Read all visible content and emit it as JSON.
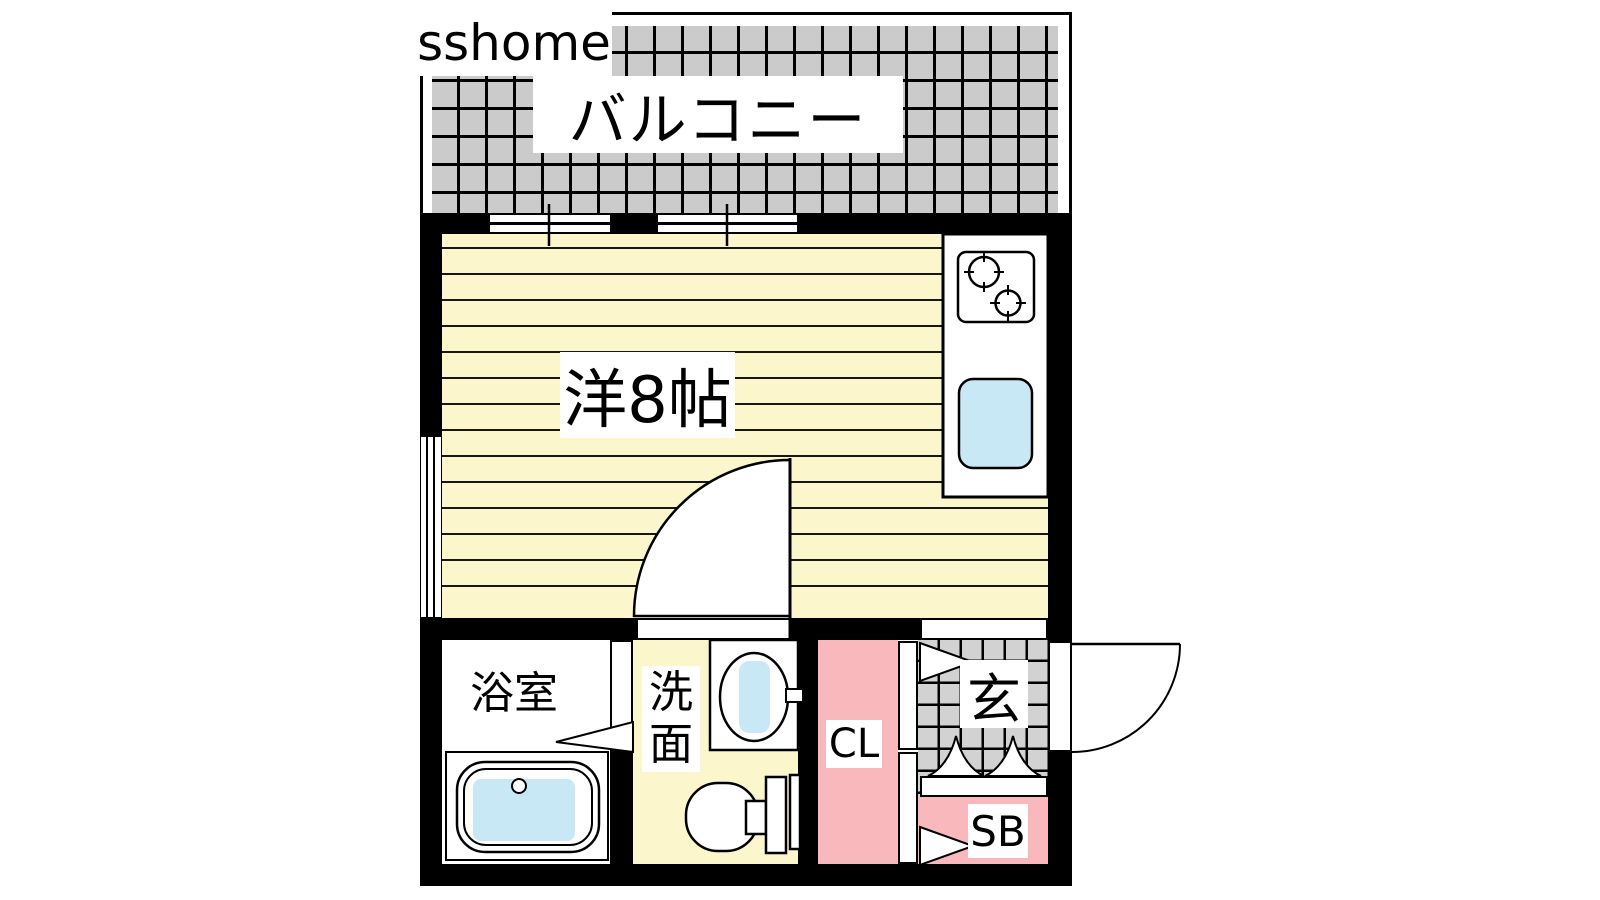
{
  "watermark": "sshome",
  "rooms": {
    "balcony": {
      "label": "バルコニー"
    },
    "main_room": {
      "label": "洋8帖"
    },
    "bathroom": {
      "label": "浴室"
    },
    "washroom": {
      "label": "洗面",
      "char1": "洗",
      "char2": "面"
    },
    "closet": {
      "label": "CL"
    },
    "entrance": {
      "label": "玄"
    },
    "shoe_box": {
      "label": "SB"
    }
  },
  "colors": {
    "wall": "#000000",
    "floor_yellow": "#fbf6cb",
    "balcony_gray": "#cbcbcb",
    "entry_gray": "#d2d2d2",
    "closet_pink": "#f8b8bc",
    "water_blue": "#c9e8f6"
  }
}
